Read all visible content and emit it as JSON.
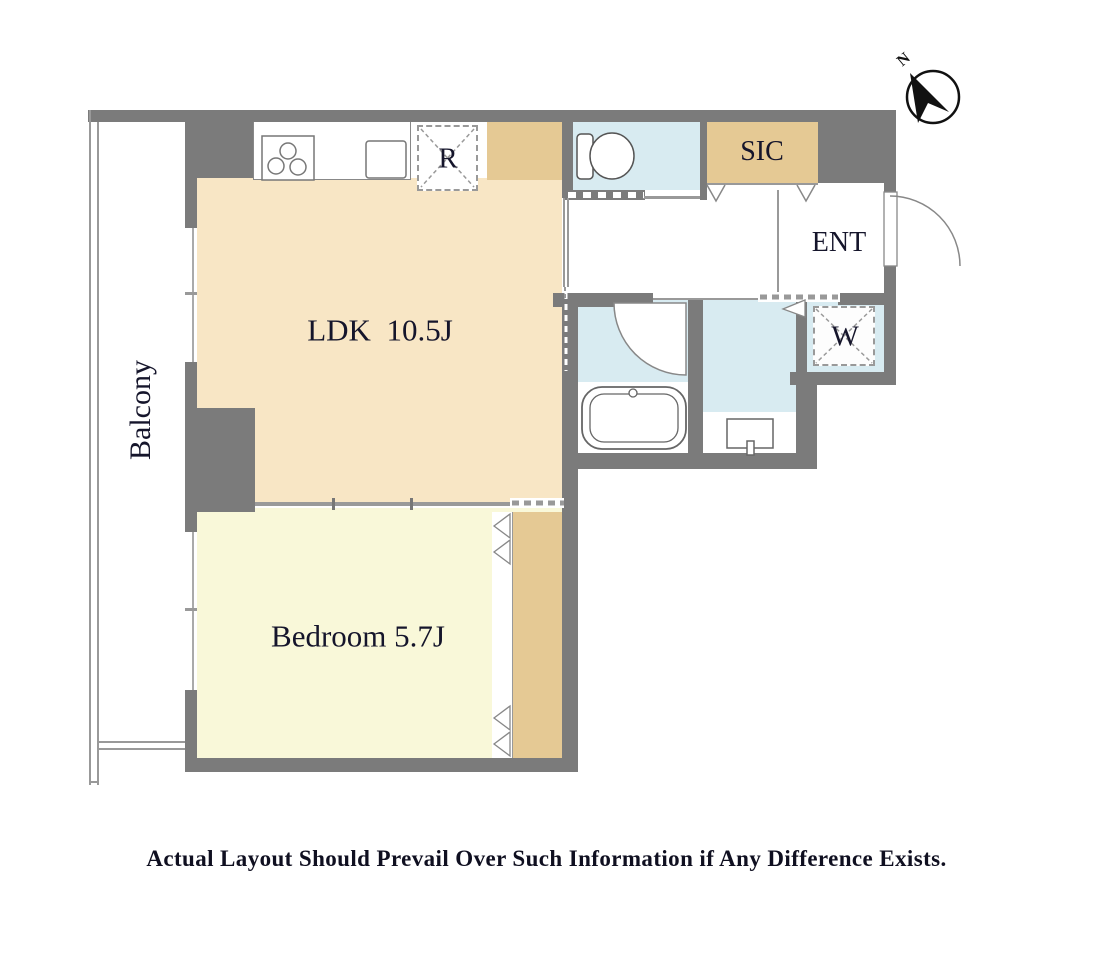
{
  "caption": "Actual Layout Should Prevail Over Such Information if Any Difference Exists.",
  "compass": {
    "north_label": "N"
  },
  "rooms": {
    "balcony": {
      "label": "Balcony"
    },
    "ldk": {
      "label": "LDK  10.5J"
    },
    "bedroom": {
      "label": "Bedroom 5.7J"
    },
    "sic": {
      "label": "SIC"
    },
    "entrance": {
      "label": "ENT"
    },
    "refrigerator_space": {
      "label": "R"
    },
    "washer_space": {
      "label": "W"
    }
  },
  "colors": {
    "wall_gray": "#7b7b7b",
    "ldk_floor": "#f8e6c5",
    "bedroom_floor": "#f9f8d9",
    "wet_room_blue": "#d8ebf1",
    "storage_tan": "#e5c994",
    "label_text": "#15152b"
  },
  "icons": {
    "compass": "compass-north-icon",
    "stove": "stove-burners-icon",
    "sink": "kitchen-sink-icon",
    "toilet": "toilet-icon",
    "bathtub": "bathtub-icon",
    "vanity": "vanity-sink-icon",
    "entrance_door": "door-swing-icon",
    "bathroom_door": "door-swing-icon"
  }
}
